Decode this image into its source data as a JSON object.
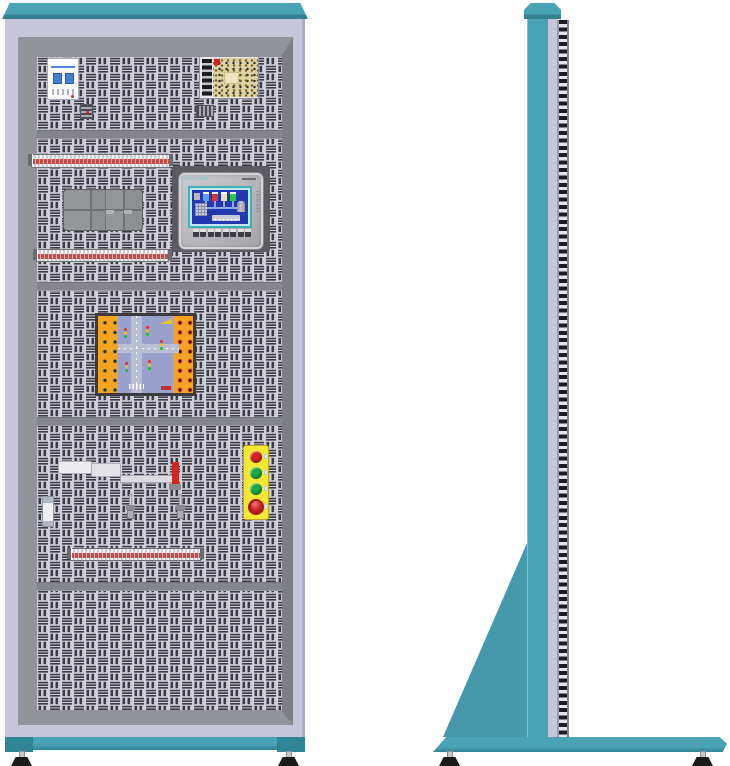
{
  "figure": {
    "type": "equipment-illustration",
    "subject": "electrical training cabinet, front and side elevation views",
    "views": [
      "front",
      "side"
    ]
  },
  "hmi": {
    "brand": "SIEMENS",
    "touch_label": "TOUCH"
  },
  "front_components": [
    "circuit-breaker",
    "din-clip",
    "power-supply",
    "terminal-strip-upper",
    "plc-module",
    "hmi-touch-panel",
    "terminal-strip-middle",
    "traffic-training-board",
    "linear-actuator",
    "relay-module",
    "toggle-switch-1",
    "toggle-switch-2",
    "pushbutton-station",
    "terminal-strip-lower",
    "leveling-feet"
  ],
  "pushbutton_station": {
    "buttons": [
      "red-button",
      "green-button",
      "green-button",
      "emergency-stop-mushroom"
    ]
  },
  "side_components": [
    "top-cap",
    "column",
    "panel-edge-strip",
    "support-gusset",
    "base-beam",
    "leveling-feet"
  ],
  "colors": {
    "teal": "#4AA2B5",
    "tealDark": "#35818F",
    "tealDeep": "#2F8496",
    "gusset": "#4599AB",
    "lavender": "#C6C5DC",
    "lavenderEdge": "#AEADC6",
    "frameGray": "#8A8A90",
    "frameLight": "#93939B",
    "frameDark": "#7E7E86",
    "meshBase": "#CFCED9",
    "meshSlot": "#3C3C45",
    "divider": "#85858D",
    "breakerBlue": "#3F7FD4",
    "psuBoard": "#DCD2A6",
    "stripRed": "#C0504D",
    "plcGray": "#8E8F92",
    "plcSeam": "#6F7074",
    "hmiPlate": "#5A5A60",
    "hmiBezel": "#BDBDC1",
    "hmiFrame": "#3FB0BC",
    "hmiScreen": "#2438B0",
    "boardOrange": "#F4A422",
    "boardBlue": "#9AA0CC",
    "roadGray": "#B9BED2",
    "boardFrame": "#3A3A40",
    "btnYellow": "#F5E832",
    "red": "#D42222",
    "green": "#18A848",
    "estopDark": "#A81818",
    "footBlack": "#1A1A1A",
    "silver": "#C8C8CC"
  }
}
